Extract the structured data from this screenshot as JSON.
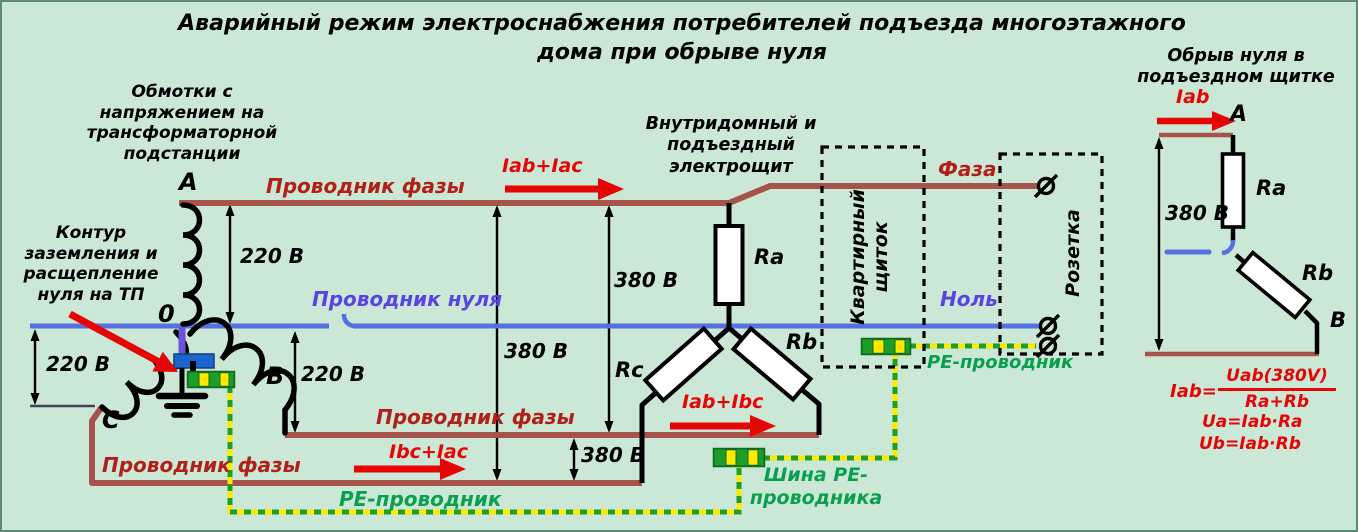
{
  "title": "Аварийный режим электроснабжения потребителей подъезда многоэтажного\nдома при обрыве нуля",
  "colors": {
    "background": "#cbe7d6",
    "phase_line": "#a5534b",
    "bright_red": "#e60505",
    "dark_red_label": "#b02018",
    "neutral_blue": "#5570e0",
    "neutral_label_violet": "#5a43e0",
    "pe_green": "#1d9e28",
    "pe_yellow": "#ffe900",
    "pe_text_green": "#0a9f4e",
    "split_block_blue": "#1b66cc"
  },
  "tp": {
    "windings_label": "Обмотки с\nнапряжением на\nтрансформаторной\nподстанции",
    "ground_label": "Контур\nзаземления и\nрасщепление\nнуля на ТП",
    "node_a": "A",
    "node_0": "0",
    "node_b": "B",
    "node_c": "C"
  },
  "conductors": {
    "phase_top": "Проводник фазы",
    "phase_mid": "Проводник фазы",
    "phase_bottom": "Проводник фазы",
    "neutral": "Проводник нуля",
    "pe_bottom": "PE-проводник",
    "pe_right": "PE-проводник",
    "pe_bus": "Шина PE-\nпроводника"
  },
  "currents": {
    "iab_iac": "Iab+Iac",
    "iab_ibc": "Iab+Ibc",
    "ibc_iac": "Ibc+Iac",
    "iab_mini": "Iab"
  },
  "voltages": {
    "v220_top": "220 В",
    "v220_left": "220 В",
    "v220_b": "220 В",
    "v380_ab": "380 В",
    "v380_ac": "380 В",
    "v380_bc": "380 В",
    "v380_mini": "380 В"
  },
  "panel": {
    "main_label": "Внутридомный и\nподъездный\nэлектрощит",
    "apartment": "Квартирный\nщиток",
    "socket": "Розетка",
    "socket_phase": "Фаза",
    "socket_neutral": "Ноль"
  },
  "resistors": {
    "ra": "Ra",
    "rb": "Rb",
    "rc": "Rc"
  },
  "mini": {
    "title": "Обрыв нуля в\nподъездном щитке",
    "node_a": "A",
    "node_b": "B",
    "ra": "Ra",
    "rb": "Rb",
    "formula_lhs": "Iab=",
    "formula_num": "Uab(380V)",
    "formula_den": "Ra+Rb",
    "formula_ua": "Ua=Iab·Ra",
    "formula_ub": "Ub=Iab·Rb"
  }
}
